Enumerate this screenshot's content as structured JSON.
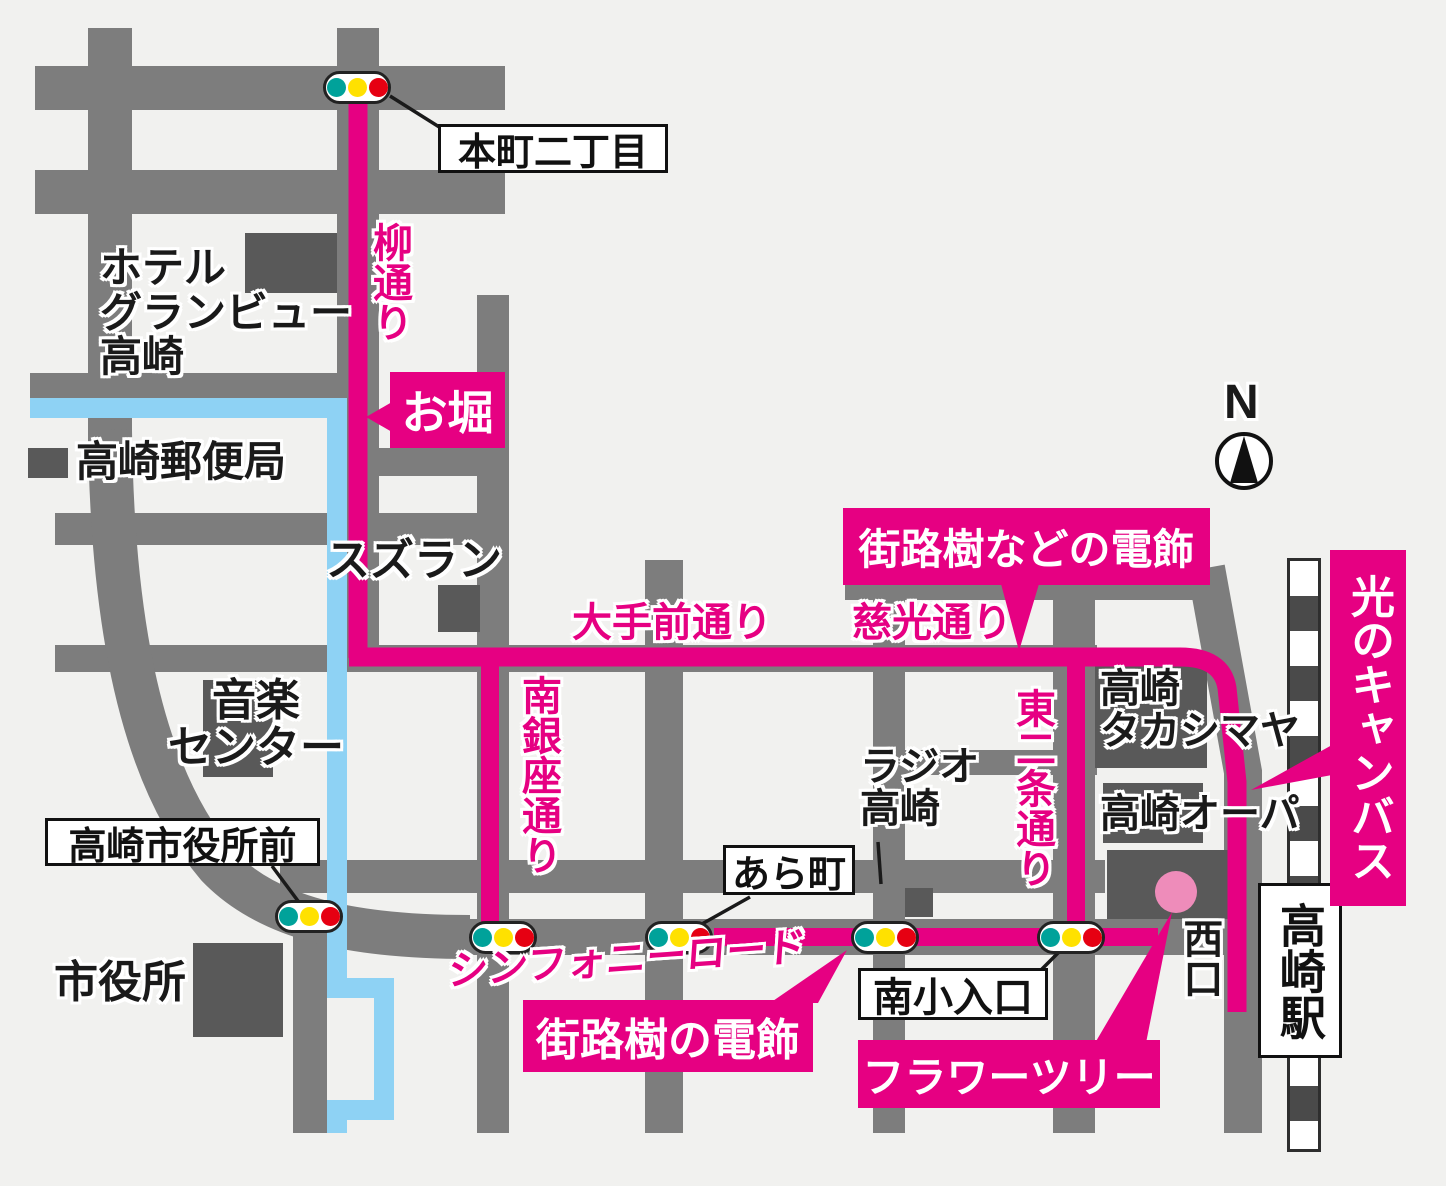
{
  "colors": {
    "background": "#f1f1ef",
    "road_gray": "#7d7d7d",
    "building_gray": "#595959",
    "route_pink": "#e60082",
    "flower_tree_pink": "#ee8cba",
    "water_blue": "#8ed2f4",
    "rail_dark": "#4a4a4a"
  },
  "compass": {
    "label": "N"
  },
  "streets": {
    "yanagi_dori": "柳通り",
    "otemae_dori": "大手前通り",
    "jiko_dori": "慈光通り",
    "minami_ginza_dori": "南銀座通り",
    "higashi_nijo_dori": "東二条通り",
    "symphony_road": "シンフォニーロード"
  },
  "highlight_badges": {
    "ohori": "お堀",
    "gairoju_nado_no_denshoku": "街路樹などの電飾",
    "gairoju_no_denshoku": "街路樹の電飾",
    "flower_tree": "フラワーツリー",
    "hikari_no_canvas": "光のキャンバス"
  },
  "intersection_signs": {
    "honmachi_2chome": "本町二丁目",
    "ara_machi": "あら町",
    "minamiko_iriguchi": "南小入口",
    "takasaki_shiyakusho_mae": "高崎市役所前"
  },
  "station": {
    "takasaki_eki": "高崎駅",
    "nishiguchi": "西口"
  },
  "places": {
    "hotel": [
      "ホテル",
      "グランビュー",
      "高崎"
    ],
    "post_office": "高崎郵便局",
    "suzuran": "スズラン",
    "music_center": [
      "音楽",
      "センター"
    ],
    "city_hall": "市役所",
    "radio_takasaki": [
      "ラジオ",
      "高崎"
    ],
    "takashimaya": [
      "高崎",
      "タカシマヤ"
    ],
    "opa": "高崎オーパ"
  }
}
